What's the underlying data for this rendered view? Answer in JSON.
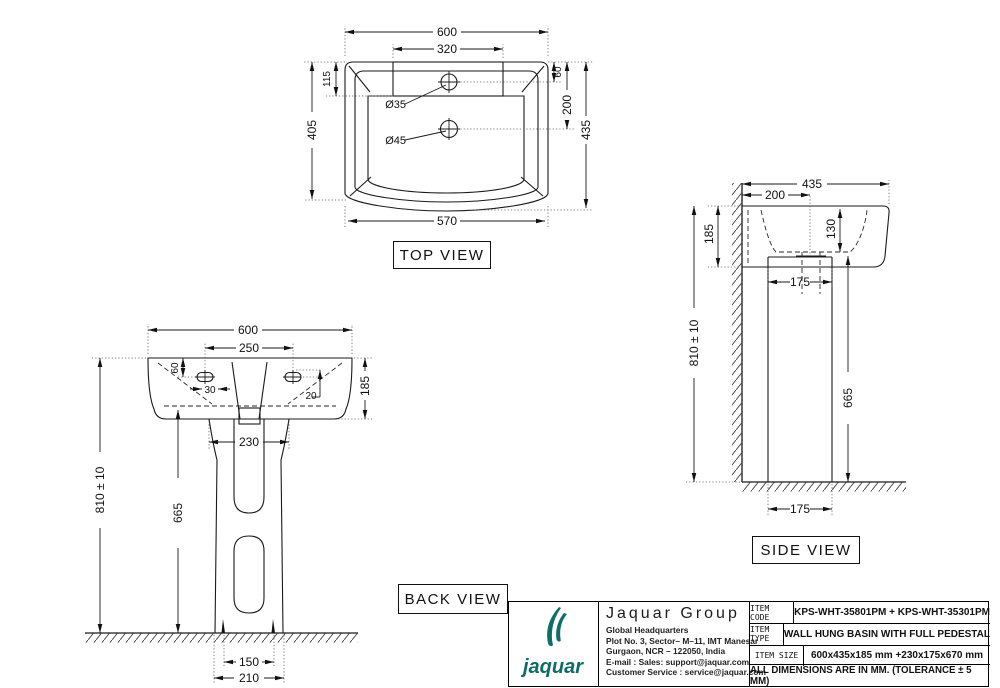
{
  "views": {
    "top": {
      "label": "TOP VIEW",
      "dims": {
        "overall_width": "600",
        "deck_width": "320",
        "deck_depth": "115",
        "basin_inner_depth": "405",
        "tap_hole_offset": "60",
        "waste_hole_offset": "200",
        "overall_depth": "435",
        "front_width": "570",
        "tap_hole_dia": "Ø35",
        "waste_hole_dia": "Ø45"
      }
    },
    "back": {
      "label": "BACK VIEW",
      "dims": {
        "overall_width": "600",
        "fixing_hole_spacing": "250",
        "fixing_hole_drop": "60",
        "fixing_hole_inset": "30",
        "slot_offset": "20",
        "basin_height": "185",
        "pedestal_top_width": "230",
        "rim_height": "810 ± 10",
        "pedestal_height": "665",
        "foot_inner_width": "150",
        "foot_width": "210"
      }
    },
    "side": {
      "label": "SIDE VIEW",
      "dims": {
        "overall_depth": "435",
        "tap_hole_center": "200",
        "basin_height": "185",
        "bowl_depth": "130",
        "pedestal_depth": "175",
        "rim_height": "810 ± 10",
        "pedestal_height": "665"
      }
    }
  },
  "title_block": {
    "logo": {
      "wordmark": "jaquar"
    },
    "company": {
      "name": "Jaquar Group",
      "line1": "Global Headquarters",
      "line2": "Plot No. 3, Sector– M–11, IMT Manesar",
      "line3": "Gurgaon, NCR – 122050, India",
      "line4": "E-mail : Sales: support@jaquar.com",
      "line5": "Customer Service : service@jaquar.com"
    },
    "rows": [
      {
        "label": "ITEM CODE",
        "value": "KPS-WHT-35801PM + KPS-WHT-35301PM"
      },
      {
        "label": "ITEM TYPE",
        "value": "WALL HUNG BASIN WITH FULL PEDESTAL"
      },
      {
        "label": "ITEM SIZE",
        "value": "600x435x185 mm +230x175x670 mm"
      }
    ],
    "note": "ALL DIMENSIONS ARE IN MM. (TOLERANCE ± 5 MM)"
  },
  "colors": {
    "line": "#1a1a1a",
    "brand_teal": "#0d6e67",
    "background": "#ffffff"
  }
}
